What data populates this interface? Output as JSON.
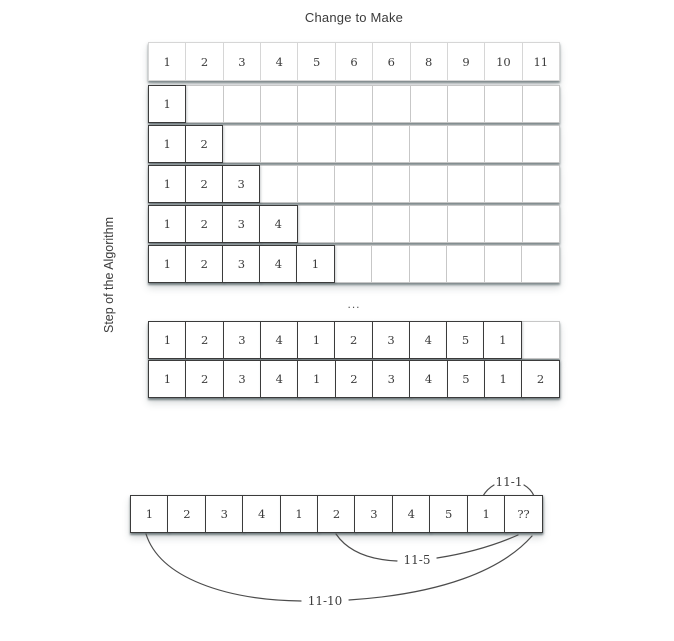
{
  "title": "Change to Make",
  "y_axis_label": "Step of the Algorithm",
  "columns": 11,
  "colors": {
    "text": "#3c3c3c",
    "border_light": "#c7c7c7",
    "border_dark": "#3b3b3b",
    "background": "#ffffff"
  },
  "header_row": {
    "values": [
      "1",
      "2",
      "3",
      "4",
      "5",
      "6",
      "6",
      "8",
      "9",
      "10",
      "11"
    ]
  },
  "steps_top": {
    "rows": [
      [
        "1"
      ],
      [
        "1",
        "2"
      ],
      [
        "1",
        "2",
        "3"
      ],
      [
        "1",
        "2",
        "3",
        "4"
      ],
      [
        "1",
        "2",
        "3",
        "4",
        "1"
      ]
    ]
  },
  "ellipsis": "...",
  "steps_bottom": {
    "rows": [
      [
        "1",
        "2",
        "3",
        "4",
        "1",
        "2",
        "3",
        "4",
        "5",
        "1"
      ],
      [
        "1",
        "2",
        "3",
        "4",
        "1",
        "2",
        "3",
        "4",
        "5",
        "1",
        "2"
      ]
    ]
  },
  "final_row": {
    "values": [
      "1",
      "2",
      "3",
      "4",
      "1",
      "2",
      "3",
      "4",
      "5",
      "1",
      "??"
    ]
  },
  "annotations": {
    "minus_one": "11-1",
    "minus_five": "11-5",
    "minus_ten": "11-10"
  }
}
